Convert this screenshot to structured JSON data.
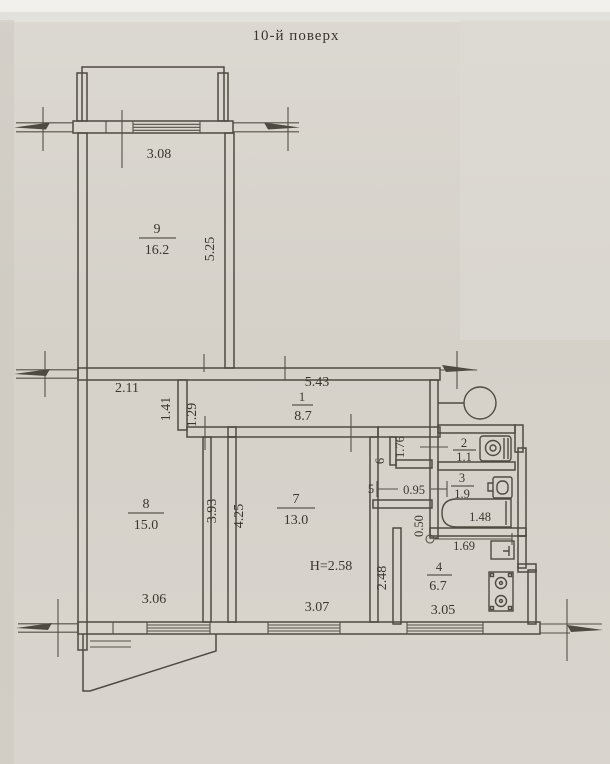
{
  "title": "10-й поверх",
  "colors": {
    "paper": "#d7d3cb",
    "ink": "#4f4a41",
    "text": "#3b372e"
  },
  "rooms": {
    "r1": {
      "number": "1",
      "area": "8.7"
    },
    "r2": {
      "number": "2",
      "area": "1.1"
    },
    "r3": {
      "number": "3",
      "area": "1.9"
    },
    "r4": {
      "number": "4",
      "area": "6.7"
    },
    "r5": {
      "number": "5"
    },
    "r6": {
      "number": "6"
    },
    "r7": {
      "number": "7",
      "area": "13.0"
    },
    "r8": {
      "number": "8",
      "area": "15.0"
    },
    "r9": {
      "number": "9",
      "area": "16.2"
    }
  },
  "dims": {
    "d308": "3.08",
    "d525": "5.25",
    "d211": "2.11",
    "d543": "5.43",
    "d141": "1.41",
    "d129": "1.29",
    "d393": "3.93",
    "d425": "4.25",
    "d176": "1.76",
    "d095": "0.95",
    "d050": "0.50",
    "d248": "2.48",
    "d148": "1.48",
    "d169": "1.69",
    "d306": "3.06",
    "d307": "3.07",
    "d305": "3.05",
    "height": "H=2.58"
  },
  "fixtures": {
    "vent": "ventilation-circle-icon",
    "toilet": "toilet-icon",
    "washbasin": "washbasin-icon",
    "bathtub": "bathtub-icon",
    "kitchen_sink": "kitchen-sink-icon",
    "stove": "stove-icon"
  }
}
